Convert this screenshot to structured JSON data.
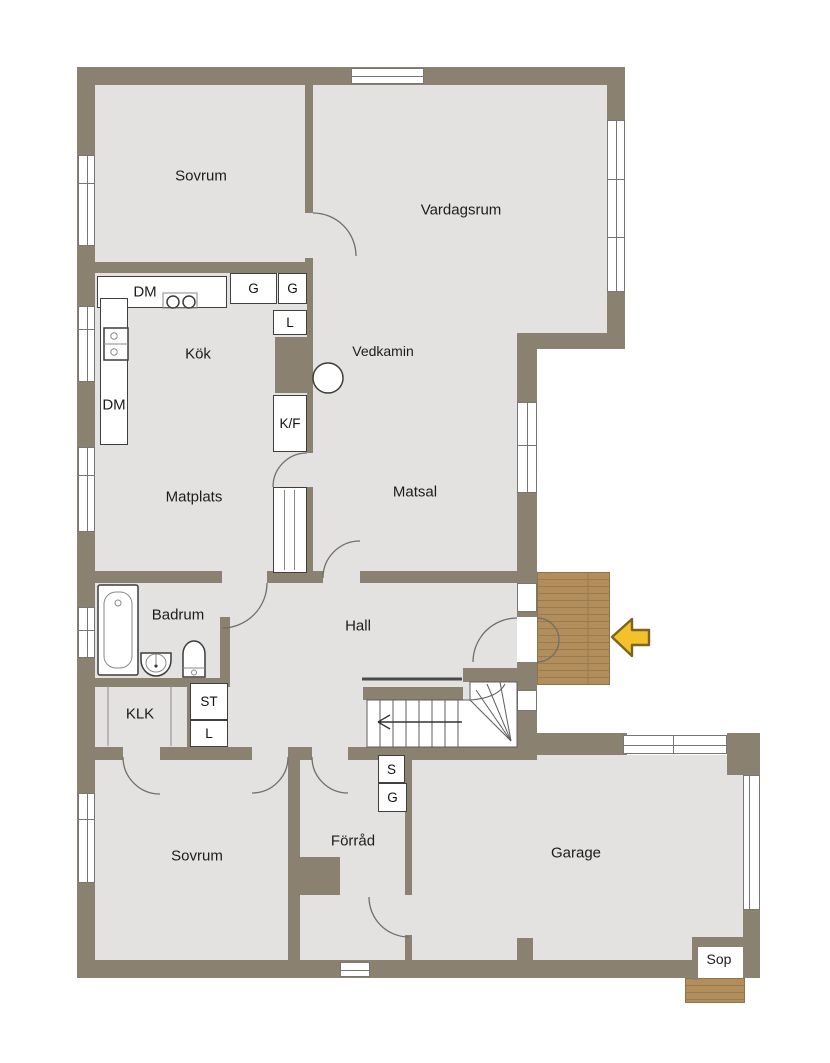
{
  "rooms": {
    "sovrum_top": "Sovrum",
    "vardagsrum": "Vardagsrum",
    "kok": "Kök",
    "vedkamin": "Vedkamin",
    "matplats": "Matplats",
    "matsal": "Matsal",
    "badrum": "Badrum",
    "hall": "Hall",
    "klk": "KLK",
    "sovrum_bottom": "Sovrum",
    "forrad": "Förråd",
    "garage": "Garage",
    "sop": "Sop"
  },
  "cabinets": {
    "dm_top": "DM",
    "dm_left": "DM",
    "g_upper_1": "G",
    "g_upper_2": "G",
    "l_kitchen": "L",
    "kf": "K/F",
    "st": "ST",
    "l_hall": "L",
    "s_forrad": "S",
    "g_forrad": "G"
  },
  "icons": {
    "entrance_arrow": "left-arrow",
    "stair_direction": "left-arrow"
  },
  "colors": {
    "wall": "#8a8170",
    "floor": "#e3e2e0",
    "wood": "#b28e5d",
    "wood_line": "#9a7a4f",
    "arrow_fill": "#f3c12b",
    "arrow_stroke": "#7c641e"
  }
}
